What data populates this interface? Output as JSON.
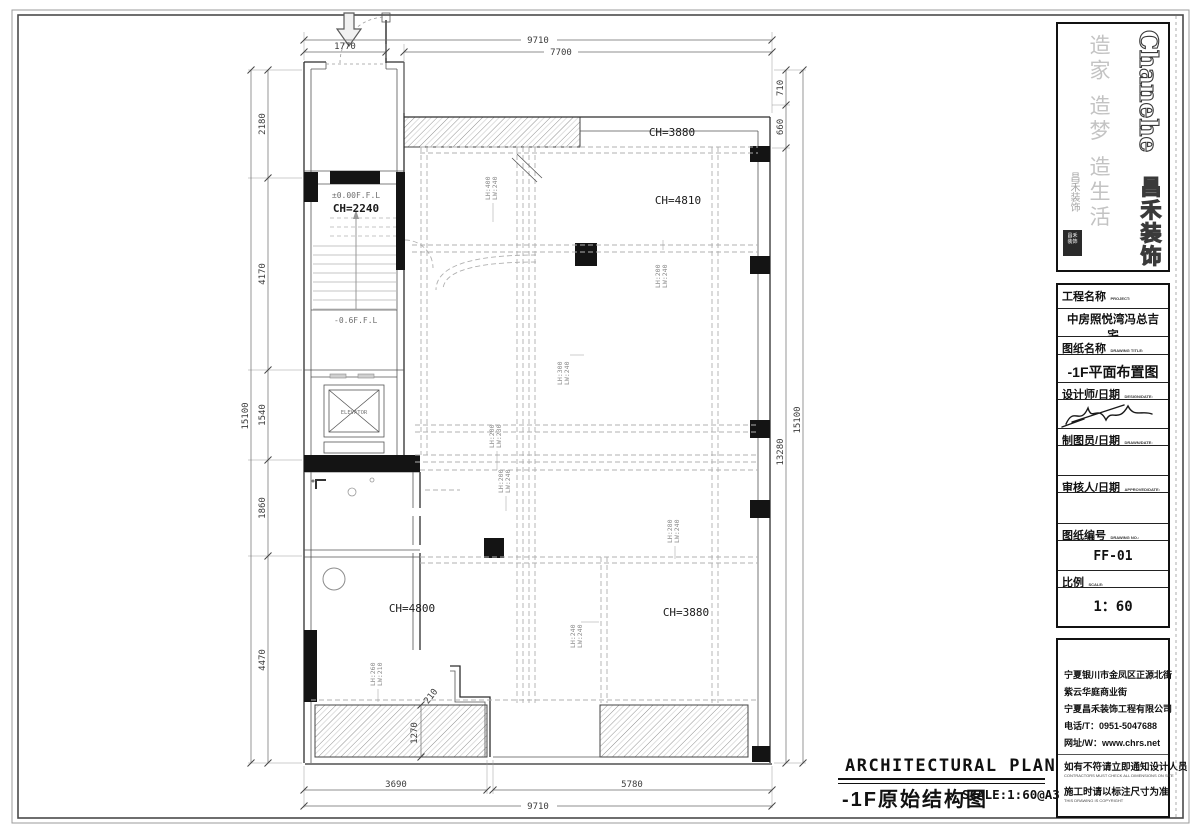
{
  "logo": {
    "brand_en": "Chanehe",
    "brand_cn": "昌禾装饰",
    "calligraphy": "造家 造梦 造生活",
    "script": "昌禾装饰",
    "seal_line1": "昌禾",
    "seal_line2": "装饰"
  },
  "title_block": {
    "project_label": "工程名称",
    "project_label_en": "PROJECT:",
    "project_value": "中房照悦湾冯总吉宅",
    "project_value_sub": "(69-101)",
    "drawing_label": "图纸名称",
    "drawing_label_en": "DRAWING TITLE:",
    "drawing_value": "-1F平面布置图",
    "designer_label": "设计师/日期",
    "designer_label_en": "DESIGN/DATE:",
    "drafter_label": "制图员/日期",
    "drafter_label_en": "DRAWN/DATE:",
    "approver_label": "审核人/日期",
    "approver_label_en": "APPROVED/DATE:",
    "number_label": "图纸编号",
    "number_label_en": "DRAWING NO.:",
    "number_value": "FF-01",
    "scale_label": "比例",
    "scale_label_en": "SCALE:",
    "scale_value": "1：60"
  },
  "contact": {
    "address1": "宁夏银川市金凤区正源北街",
    "address2": "紫云华庭商业街",
    "company": "宁夏昌禾装饰工程有限公司",
    "phone": "电话/T：0951-5047688",
    "website": "网址/W：www.chrs.net",
    "notice1": "如有不符请立即通知设计人员",
    "notice1_en": "CONTRACTORS MUST CHECK ALL DIMENSIONS ON SITE",
    "notice2": "施工时请以标注尺寸为准",
    "notice2_en": "THIS DRAWING IS COPYRIGHT"
  },
  "footer": {
    "title_en": "ARCHITECTURAL PLAN",
    "title_cn": "-1F原始结构图",
    "scale_note": "SCALE:1:60@A3"
  },
  "plan": {
    "rooms": {
      "ch_top": "CH=3880",
      "ch_hall": "CH=4810",
      "ch_stair": "CH=2240",
      "ch_room_left": "CH=4800",
      "ch_room_right": "CH=3880",
      "level_entry": "±0.00F.F.L",
      "level_lower": "-0.6F.F.L",
      "elevator": "ELEVATOR"
    },
    "dims": {
      "top_overall": "9710",
      "top_entry": "1770",
      "top_main": "7700",
      "right_a": "710",
      "right_b": "660",
      "right_c": "13280",
      "right_overall": "15100",
      "left_a": "2180",
      "left_b": "4170",
      "left_c": "1540",
      "left_d": "1860",
      "left_e": "4470",
      "left_overall": "15100",
      "bottom_a": "3690",
      "bottom_b": "5780",
      "bottom_overall": "9710",
      "wall_h": "1270",
      "wall_t": "210"
    },
    "beams": {
      "b1": {
        "lh": "LH:400",
        "lw": "LW:240"
      },
      "b2": {
        "lh": "LH:200",
        "lw": "LW:240"
      },
      "b3": {
        "lh": "LH:300",
        "lw": "LW:240"
      },
      "b4": {
        "lh": "LH:200",
        "lw": "LW:230"
      },
      "b5": {
        "lh": "LH:200",
        "lw": "LW:240"
      },
      "b6": {
        "lh": "LH:280",
        "lw": "LW:240"
      },
      "b7": {
        "lh": "LH:240",
        "lw": "LW:240"
      },
      "b8": {
        "lh": "LH:260",
        "lw": "LW:210"
      }
    }
  }
}
